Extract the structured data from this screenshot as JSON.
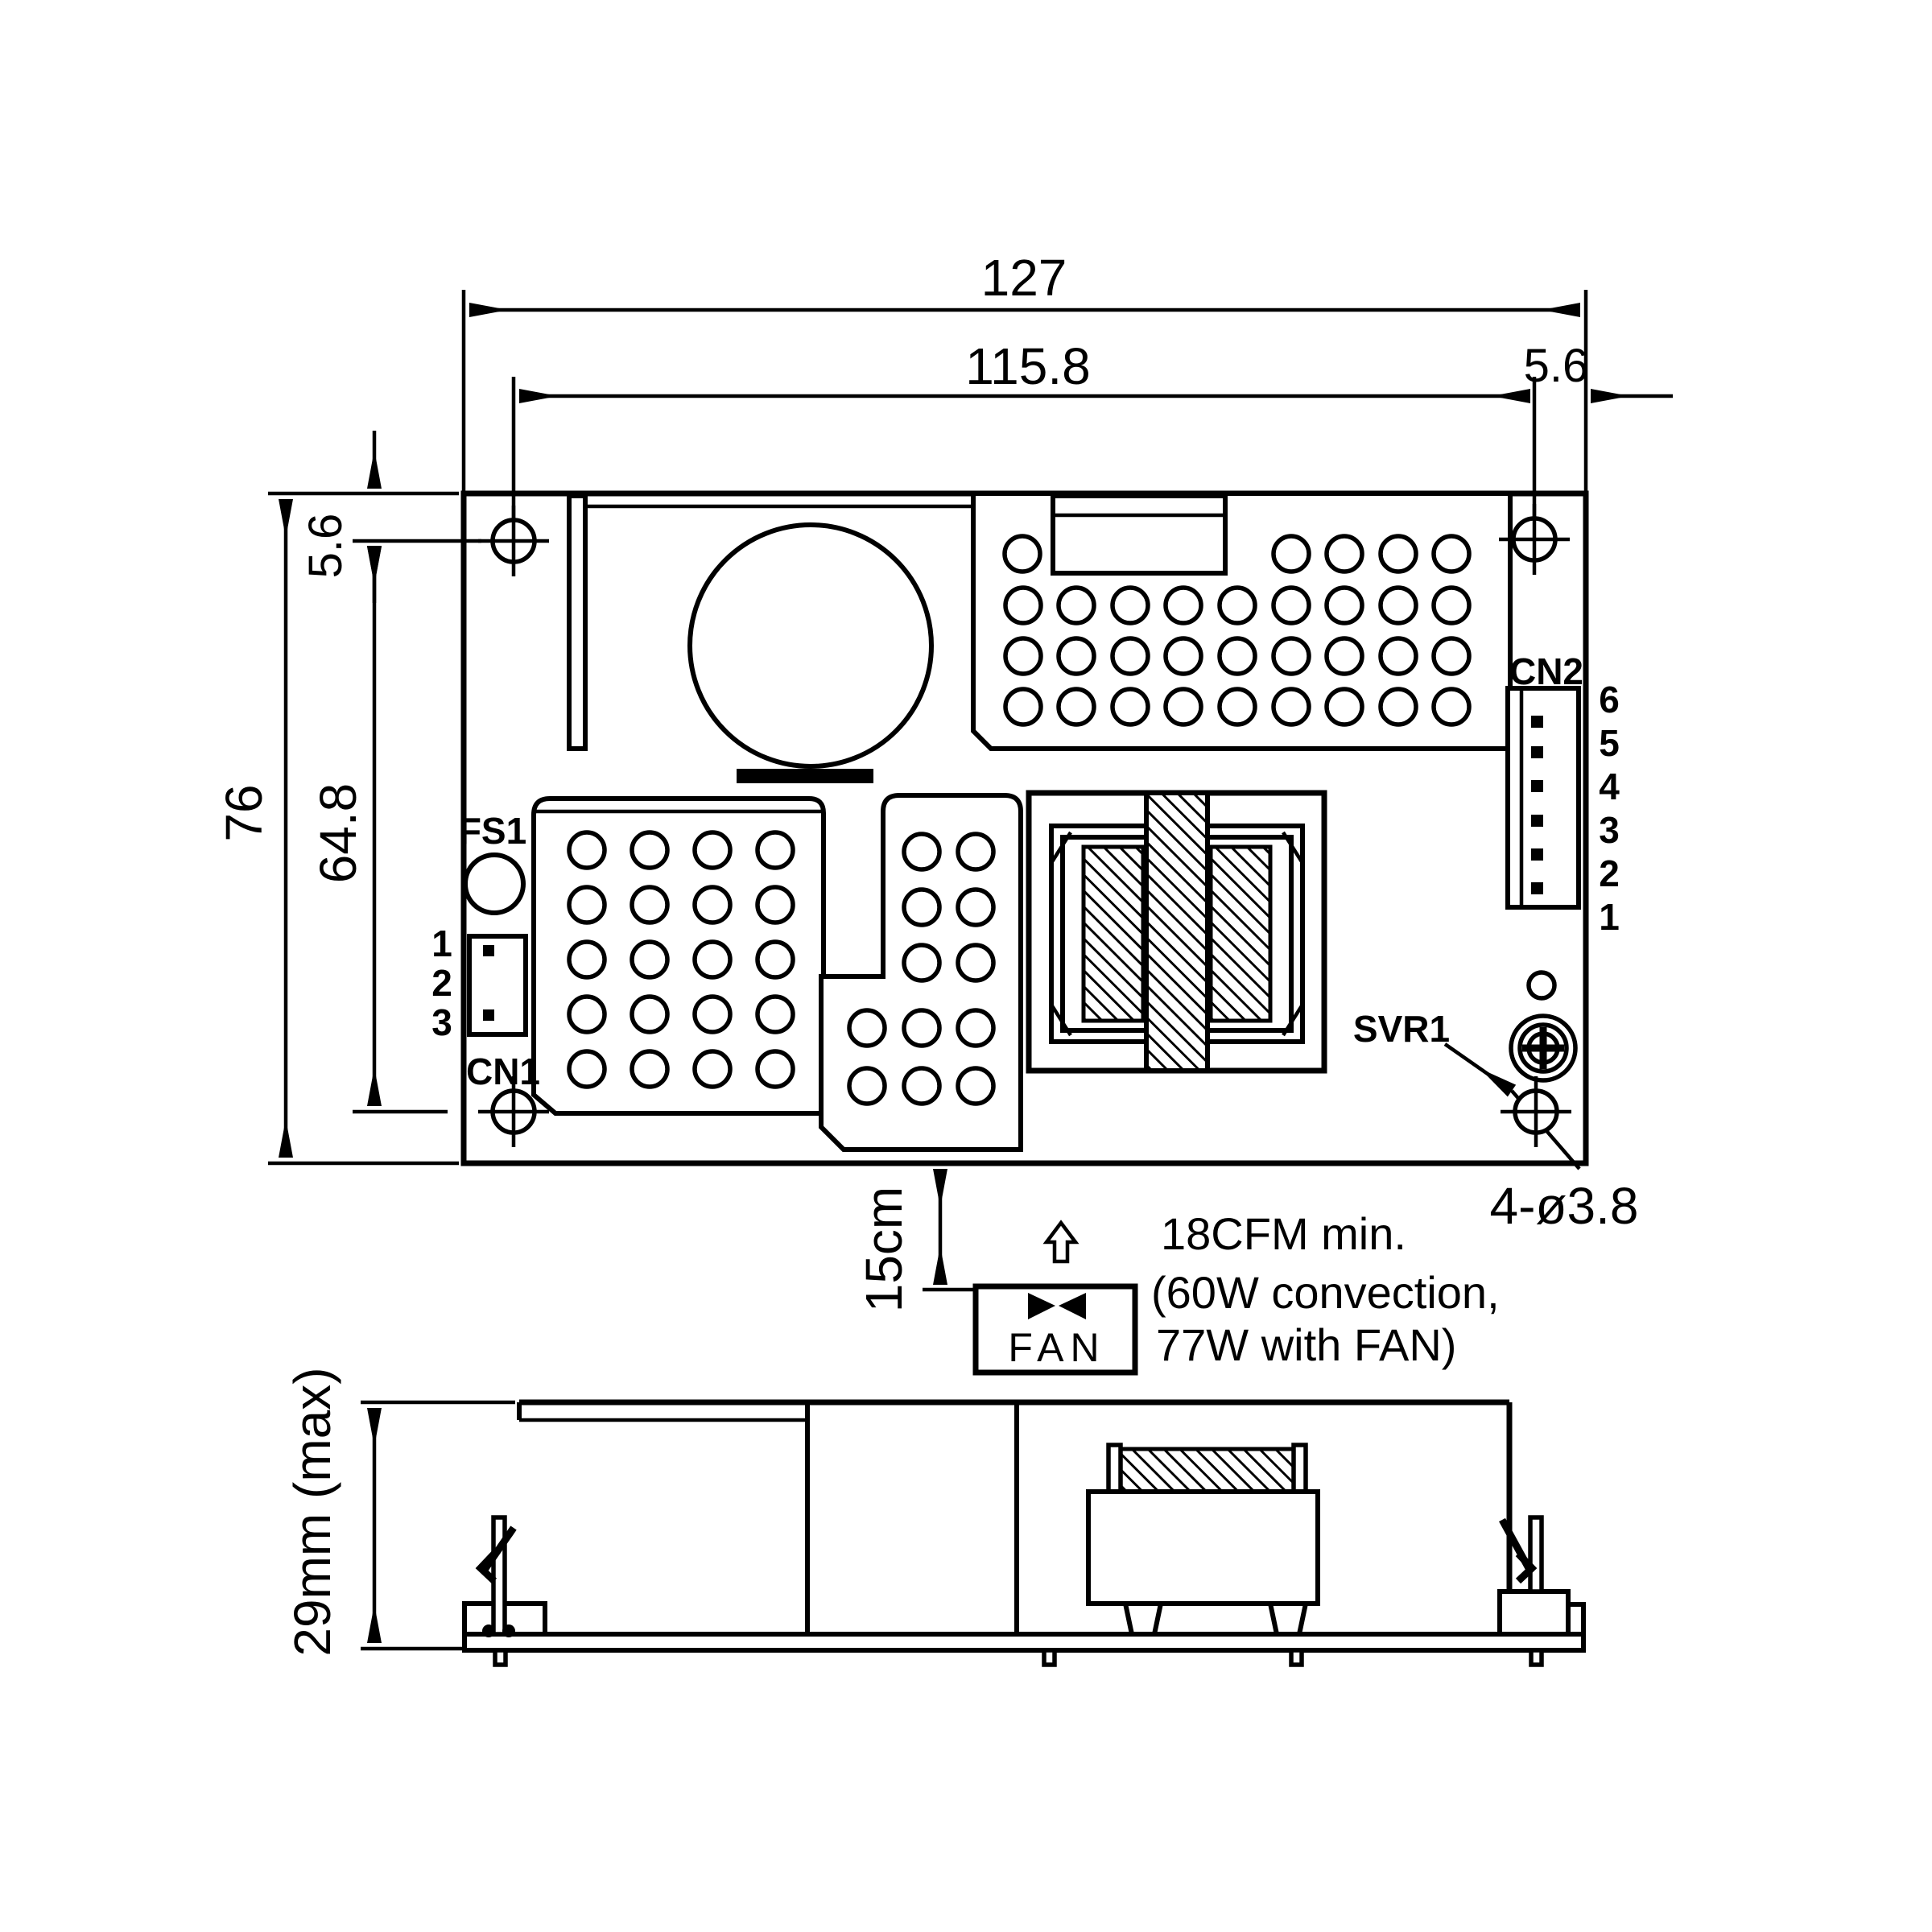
{
  "drawing": {
    "kind": "power-supply-mechanical-drawing",
    "units": "mm",
    "colors": {
      "ink": "#000000",
      "background": "#ffffff"
    },
    "dims": {
      "overall_width": "127",
      "hole_pitch_x": "115.8",
      "edge_offset_right": "5.6",
      "edge_offset_top": "5.6",
      "overall_height": "76",
      "hole_pitch_y": "64.8",
      "fan_clearance": "15cm",
      "mounting_holes": "4-ø3.8",
      "max_component_height": "29mm (max)"
    },
    "labels": {
      "fuse": "FS1",
      "connector1": "CN1",
      "connector2": "CN2",
      "trimmer": "SVR1",
      "fan": "FAN"
    },
    "cn1_pins": [
      "1",
      "2",
      "3"
    ],
    "cn2_pins": [
      "6",
      "5",
      "4",
      "3",
      "2",
      "1"
    ],
    "airflow_note": {
      "line1": "18CFM min.",
      "line2": "(60W convection,",
      "line3": "77W with FAN)"
    }
  }
}
